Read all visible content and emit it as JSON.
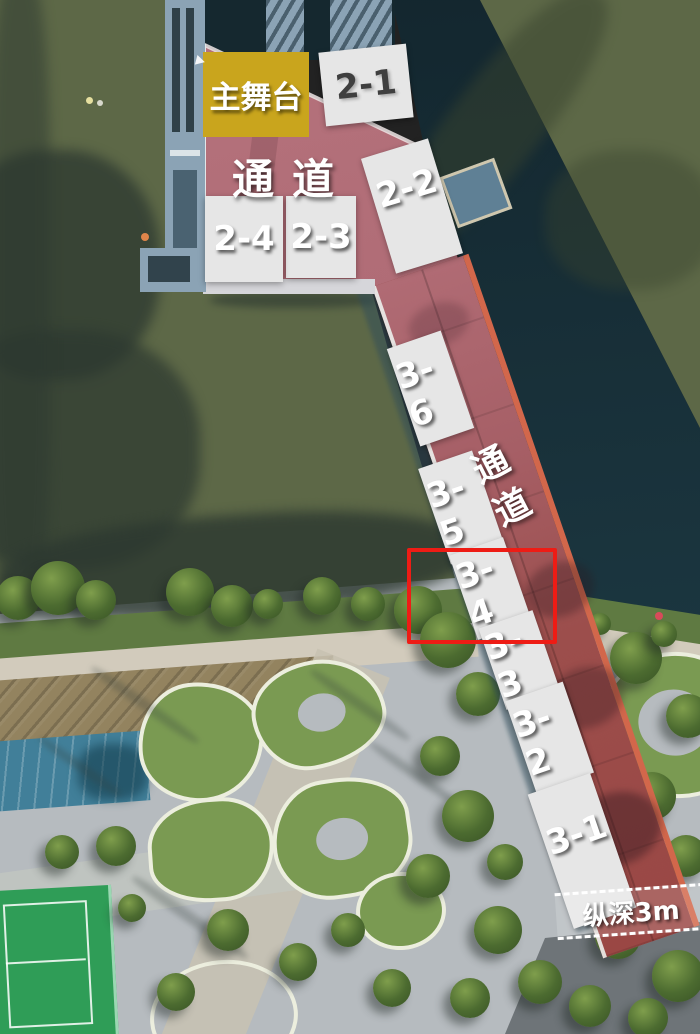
{
  "stage": {
    "label": "主舞台"
  },
  "corridors": {
    "top": "通道",
    "side": "通道"
  },
  "booths": {
    "b2_1": "2-1",
    "b2_2": "2-2",
    "b2_3": "2-3",
    "b2_4": "2-4",
    "b3_1": "3-1",
    "b3_2": "3-2",
    "b3_3": "3-3",
    "b3_4": "3-4",
    "b3_5": "3-5",
    "b3_6": "3-6"
  },
  "highlight": {
    "target": "3-4"
  },
  "depth": {
    "label": "纵深3m"
  },
  "colors": {
    "stage_fill": "#c9a51d",
    "booth_fill": "#e6e6e6",
    "booth_text_dark": "#3f3f3f",
    "label_white": "#ffffff",
    "highlight_red": "#ee1c15",
    "bridge_red": "#9a4744",
    "edge_orange": "#d2674b",
    "water_olive": "#5d6847",
    "shore_green": "#5f7a42",
    "promenade": "#d2cbbc",
    "terrace": "#93835f",
    "pool_blue": "#417f99",
    "hedge_green": "#7a9a52",
    "hedge_border": "#eceede",
    "court_green": "#2f9d57",
    "pavement": "#b6bbbf",
    "pavement_dark": "#6e7478",
    "pier_blue": "#8ba3b5"
  }
}
